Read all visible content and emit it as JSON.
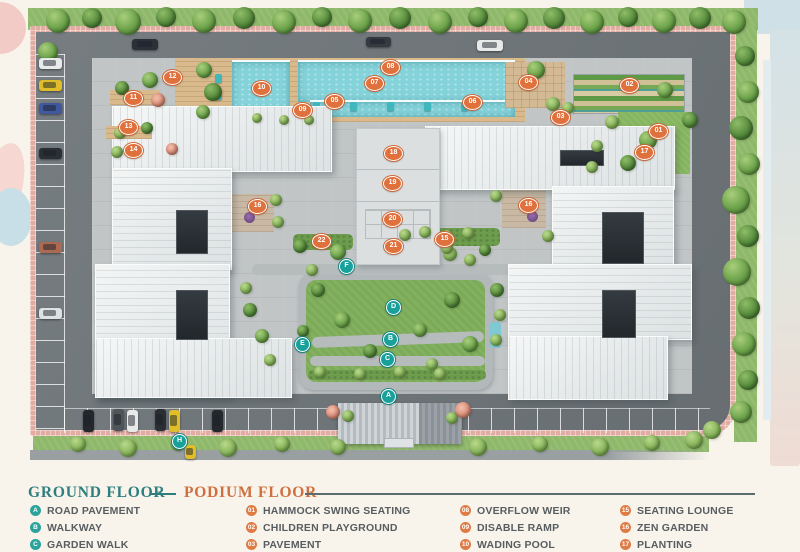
{
  "legend": {
    "ground_title": "GROUND FLOOR",
    "podium_title": "PODIUM FLOOR",
    "columns": [
      {
        "kind": "ground",
        "items": [
          {
            "key": "A",
            "label": "ROAD PAVEMENT"
          },
          {
            "key": "B",
            "label": "WALKWAY"
          },
          {
            "key": "C",
            "label": "GARDEN WALK"
          }
        ]
      },
      {
        "kind": "podium",
        "items": [
          {
            "key": "01",
            "label": "HAMMOCK SWING SEATING"
          },
          {
            "key": "02",
            "label": "CHILDREN PLAYGROUND"
          },
          {
            "key": "03",
            "label": "PAVEMENT"
          }
        ]
      },
      {
        "kind": "podium",
        "items": [
          {
            "key": "08",
            "label": "OVERFLOW WEIR"
          },
          {
            "key": "09",
            "label": "DISABLE RAMP"
          },
          {
            "key": "10",
            "label": "WADING POOL"
          }
        ]
      },
      {
        "kind": "podium",
        "items": [
          {
            "key": "15",
            "label": "SEATING LOUNGE"
          },
          {
            "key": "16",
            "label": "ZEN GARDEN"
          },
          {
            "key": "17",
            "label": "PLANTING"
          }
        ]
      }
    ]
  },
  "colors": {
    "ground_teal": "#2c7f7e",
    "podium_orange": "#cf6f3e",
    "marker_orange": "#e0703c",
    "marker_teal": "#18a19b",
    "pool_water": "#85d3da",
    "lawn_green": "#7cab57",
    "road_gray": "#6f767a",
    "paver_pink": "#e3aca3"
  },
  "plan": {
    "podium_markers": [
      [
        "01",
        658,
        131
      ],
      [
        "02",
        629,
        85
      ],
      [
        "03",
        560,
        117
      ],
      [
        "04",
        528,
        82
      ],
      [
        "05",
        334,
        101
      ],
      [
        "06",
        472,
        102
      ],
      [
        "07",
        374,
        83
      ],
      [
        "08",
        390,
        67
      ],
      [
        "09",
        302,
        110
      ],
      [
        "10",
        261,
        88
      ],
      [
        "11",
        133,
        98
      ],
      [
        "12",
        172,
        77
      ],
      [
        "13",
        128,
        127
      ],
      [
        "14",
        133,
        150
      ],
      [
        "15",
        444,
        239
      ],
      [
        "16",
        528,
        205
      ],
      [
        "16",
        257,
        206
      ],
      [
        "17",
        644,
        152
      ],
      [
        "18",
        393,
        153
      ],
      [
        "19",
        392,
        183
      ],
      [
        "20",
        392,
        219
      ],
      [
        "21",
        393,
        246
      ],
      [
        "22",
        321,
        241
      ]
    ],
    "ground_markers": [
      [
        "A",
        388,
        396
      ],
      [
        "B",
        390,
        339
      ],
      [
        "C",
        387,
        359
      ],
      [
        "D",
        393,
        307
      ],
      [
        "E",
        302,
        344
      ],
      [
        "F",
        346,
        266
      ],
      [
        "H",
        179,
        441
      ]
    ],
    "cars": [
      [
        145,
        44,
        26,
        11,
        "#2b3036"
      ],
      [
        378,
        42,
        25,
        10,
        "#343a40"
      ],
      [
        490,
        45,
        26,
        11,
        "#e8eaea"
      ],
      [
        50,
        63,
        23,
        11,
        "#e8eaea"
      ],
      [
        50,
        85,
        23,
        11,
        "#dfbe2a"
      ],
      [
        50,
        108,
        23,
        11,
        "#41589e"
      ],
      [
        50,
        153,
        23,
        11,
        "#2b2f34"
      ],
      [
        50,
        247,
        23,
        11,
        "#ad6a52"
      ],
      [
        50,
        313,
        23,
        11,
        "#dfe2e2"
      ],
      [
        88,
        421,
        11,
        22,
        "#24282c"
      ],
      [
        118,
        420,
        11,
        22,
        "#4e5458"
      ],
      [
        132,
        421,
        11,
        22,
        "#e8eaea"
      ],
      [
        160,
        420,
        11,
        22,
        "#2b2f34"
      ],
      [
        174,
        421,
        11,
        22,
        "#dfbe2a"
      ],
      [
        217,
        421,
        11,
        22,
        "#24282c"
      ],
      [
        190,
        452,
        11,
        14,
        "#dfbe2a"
      ]
    ],
    "trees": [
      [
        58,
        21,
        12,
        0
      ],
      [
        92,
        18,
        10,
        1
      ],
      [
        128,
        22,
        13,
        0
      ],
      [
        166,
        17,
        10,
        1
      ],
      [
        204,
        21,
        12,
        0
      ],
      [
        244,
        18,
        11,
        1
      ],
      [
        284,
        22,
        12,
        0
      ],
      [
        322,
        17,
        10,
        1
      ],
      [
        360,
        21,
        12,
        0
      ],
      [
        400,
        18,
        11,
        1
      ],
      [
        440,
        22,
        12,
        0
      ],
      [
        478,
        17,
        10,
        1
      ],
      [
        516,
        21,
        12,
        0
      ],
      [
        554,
        18,
        11,
        1
      ],
      [
        592,
        22,
        12,
        0
      ],
      [
        628,
        17,
        10,
        1
      ],
      [
        664,
        21,
        12,
        0
      ],
      [
        700,
        18,
        11,
        1
      ],
      [
        734,
        22,
        12,
        0
      ],
      [
        745,
        56,
        10,
        1
      ],
      [
        748,
        92,
        11,
        0
      ],
      [
        741,
        128,
        12,
        1
      ],
      [
        749,
        164,
        11,
        0
      ],
      [
        736,
        200,
        14,
        0
      ],
      [
        748,
        236,
        11,
        1
      ],
      [
        737,
        272,
        14,
        0
      ],
      [
        749,
        308,
        11,
        1
      ],
      [
        744,
        344,
        12,
        0
      ],
      [
        748,
        380,
        10,
        1
      ],
      [
        741,
        412,
        11,
        0
      ],
      [
        78,
        444,
        8,
        2
      ],
      [
        128,
        448,
        9,
        2
      ],
      [
        178,
        443,
        8,
        2
      ],
      [
        228,
        448,
        9,
        2
      ],
      [
        282,
        444,
        8,
        2
      ],
      [
        338,
        447,
        8,
        2
      ],
      [
        478,
        447,
        9,
        2
      ],
      [
        540,
        444,
        8,
        2
      ],
      [
        600,
        447,
        9,
        2
      ],
      [
        652,
        443,
        8,
        2
      ],
      [
        694,
        440,
        9,
        2
      ],
      [
        712,
        430,
        9,
        2
      ],
      [
        48,
        52,
        10,
        0
      ],
      [
        204,
        70,
        8,
        0
      ],
      [
        213,
        92,
        9,
        1
      ],
      [
        203,
        112,
        7,
        0
      ],
      [
        257,
        118,
        5,
        2
      ],
      [
        284,
        120,
        5,
        2
      ],
      [
        309,
        120,
        5,
        2
      ],
      [
        150,
        80,
        8,
        0
      ],
      [
        122,
        88,
        7,
        1
      ],
      [
        158,
        100,
        7,
        3
      ],
      [
        120,
        133,
        6,
        2
      ],
      [
        147,
        128,
        6,
        1
      ],
      [
        172,
        149,
        6,
        3
      ],
      [
        117,
        152,
        6,
        2
      ],
      [
        536,
        70,
        9,
        0
      ],
      [
        553,
        104,
        7,
        2
      ],
      [
        568,
        108,
        6,
        2
      ],
      [
        612,
        122,
        7,
        2
      ],
      [
        648,
        140,
        9,
        0
      ],
      [
        597,
        146,
        6,
        2
      ],
      [
        628,
        163,
        8,
        1
      ],
      [
        592,
        167,
        6,
        2
      ],
      [
        665,
        90,
        8,
        0
      ],
      [
        690,
        120,
        8,
        1
      ],
      [
        276,
        200,
        6,
        2
      ],
      [
        278,
        222,
        6,
        2
      ],
      [
        300,
        246,
        7,
        1
      ],
      [
        338,
        252,
        8,
        0
      ],
      [
        312,
        270,
        6,
        2
      ],
      [
        496,
        196,
        6,
        2
      ],
      [
        548,
        236,
        6,
        2
      ],
      [
        450,
        254,
        7,
        2
      ],
      [
        470,
        260,
        6,
        2
      ],
      [
        485,
        250,
        6,
        1
      ],
      [
        447,
        248,
        6,
        2
      ],
      [
        405,
        235,
        6,
        2
      ],
      [
        425,
        232,
        6,
        2
      ],
      [
        447,
        236,
        6,
        2
      ],
      [
        468,
        233,
        6,
        2
      ],
      [
        318,
        290,
        7,
        1
      ],
      [
        342,
        320,
        8,
        0
      ],
      [
        303,
        331,
        6,
        1
      ],
      [
        420,
        330,
        7,
        0
      ],
      [
        452,
        300,
        8,
        1
      ],
      [
        470,
        344,
        8,
        0
      ],
      [
        370,
        351,
        7,
        1
      ],
      [
        432,
        364,
        6,
        2
      ],
      [
        497,
        290,
        7,
        1
      ],
      [
        500,
        315,
        6,
        2
      ],
      [
        496,
        340,
        6,
        2
      ],
      [
        250,
        310,
        7,
        1
      ],
      [
        262,
        336,
        7,
        0
      ],
      [
        246,
        288,
        6,
        2
      ],
      [
        270,
        360,
        6,
        2
      ],
      [
        320,
        372,
        6,
        2
      ],
      [
        360,
        374,
        6,
        2
      ],
      [
        400,
        372,
        6,
        2
      ],
      [
        440,
        374,
        6,
        2
      ],
      [
        333,
        412,
        7,
        3
      ],
      [
        463,
        410,
        8,
        3
      ],
      [
        348,
        416,
        6,
        2
      ],
      [
        452,
        418,
        6,
        2
      ]
    ]
  }
}
